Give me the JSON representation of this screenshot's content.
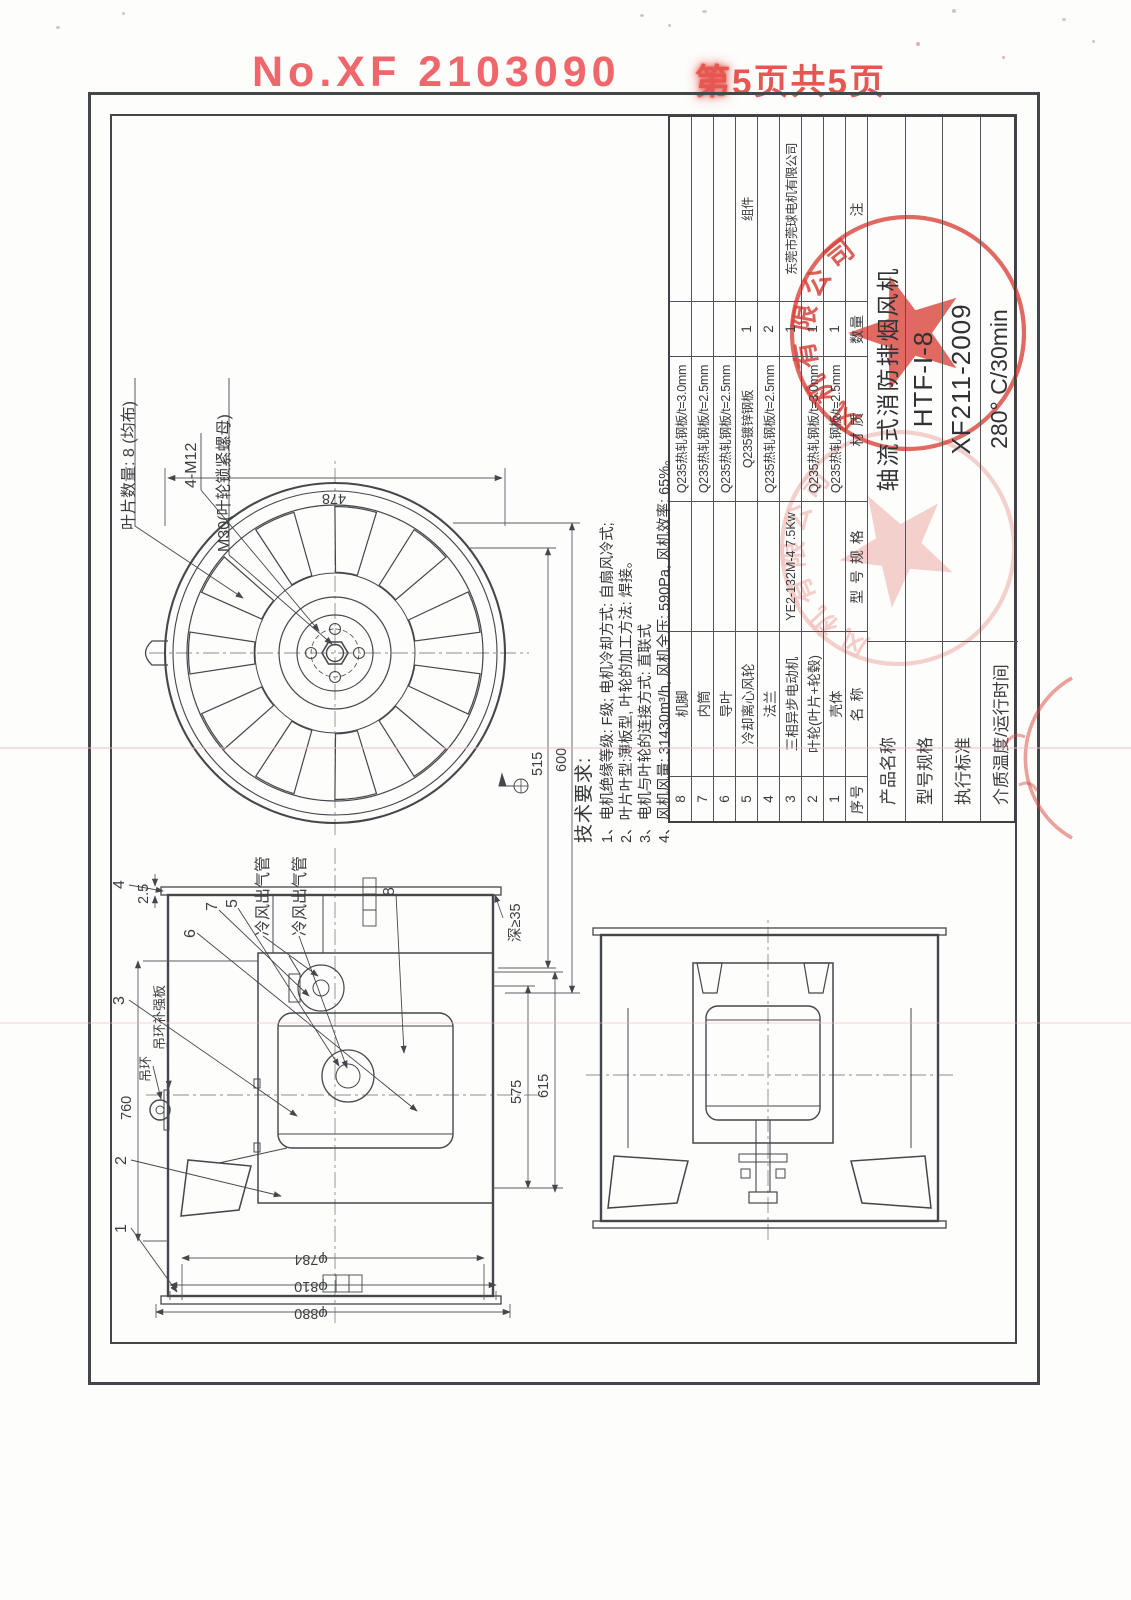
{
  "header": {
    "doc_number": "No.XF 2103090",
    "page_info": "第5页共5页"
  },
  "parts_table": {
    "headers": [
      "序号",
      "名  称",
      "型 号 规 格",
      "材  质",
      "数量",
      "注"
    ],
    "rows": [
      [
        "8",
        "机脚",
        "",
        "Q235热轧钢板/t=3.0mm",
        "",
        ""
      ],
      [
        "7",
        "内筒",
        "",
        "Q235热轧钢板/t=2.5mm",
        "",
        ""
      ],
      [
        "6",
        "导叶",
        "",
        "Q235热轧钢板/t=2.5mm",
        "",
        ""
      ],
      [
        "5",
        "冷却离心风轮",
        "",
        "Q235镀锌钢板",
        "1",
        "组件"
      ],
      [
        "4",
        "法兰",
        "",
        "Q235热轧钢板/t=2.5mm",
        "2",
        ""
      ],
      [
        "3",
        "三相异步电动机",
        "YE2-132M-4 7.5Kw",
        "",
        "1",
        "东莞市莞球电机有限公司"
      ],
      [
        "2",
        "叶轮(叶片+轮毂)",
        "",
        "Q235热轧钢板/t=3.0mm",
        "1",
        ""
      ],
      [
        "1",
        "壳体",
        "",
        "Q235热轧钢板/t=2.5mm",
        "1",
        ""
      ]
    ]
  },
  "title_block": {
    "rows": [
      {
        "label": "产品名称",
        "value": "轴流式消防排烟风机"
      },
      {
        "label": "型号规格",
        "value": "HTF-I-8"
      },
      {
        "label": "执行标准",
        "value": "XF211-2009"
      },
      {
        "label": "介质温度/运行时间",
        "value": "280° C/30min"
      }
    ]
  },
  "tech_requirements": {
    "title": "技术要求:",
    "items": [
      "1、电机绝缘等级: F级; 电机冷却方式: 自扇风冷式;",
      "2、叶片叶型:薄板型, 叶轮的加工方法: 焊接。",
      "3、电机与叶轮的连接方式: 直联式",
      "4、风机风量: 31430m³/h, 风机全压: 590Pa, 风机效率: 65%。"
    ]
  },
  "front_view": {
    "blade_count_label": "叶片数量: 8 (均布)",
    "bolt_label": "4-M12",
    "nut_label": "M30(叶轮锁紧螺母)",
    "dims": {
      "d478": "478",
      "d515": "515",
      "d600": "600"
    }
  },
  "side_view": {
    "dims": {
      "d760": "760",
      "d25": "2.5",
      "d575": "575",
      "d615": "615",
      "depth": "深≥35",
      "dia1": "φ784",
      "dia2": "φ810",
      "dia3": "φ880"
    },
    "labels": {
      "cooling_pipe": "冷风出气管",
      "lift_ring": "吊环",
      "lift_plate": "吊环补强板"
    },
    "callouts": [
      "1",
      "2",
      "3",
      "4",
      "5",
      "6",
      "7",
      "8"
    ]
  },
  "stamp": {
    "arc_text": "风机有限公司",
    "color": "#d8443c"
  }
}
